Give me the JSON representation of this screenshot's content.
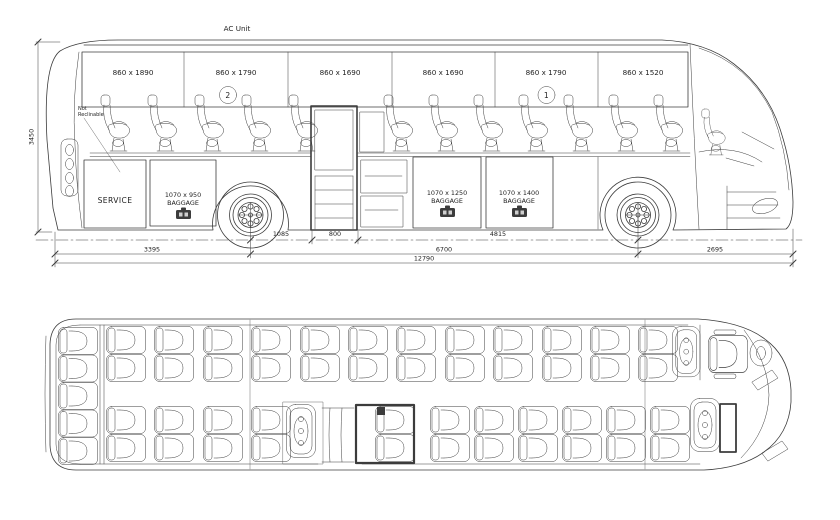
{
  "side_view": {
    "ac_unit_label": "AC Unit",
    "overall_height": "3450",
    "not_reclinable_1": "Not",
    "not_reclinable_2": "Reclinable",
    "service_label": "SERVICE",
    "windows": [
      {
        "label": "860 x 1890",
        "badge": ""
      },
      {
        "label": "860 x 1790",
        "badge": "2"
      },
      {
        "label": "860 x 1690",
        "badge": ""
      },
      {
        "label": "860 x 1690",
        "badge": ""
      },
      {
        "label": "860 x 1790",
        "badge": "1"
      },
      {
        "label": "860 x 1520",
        "badge": ""
      }
    ],
    "baggage_doors": [
      {
        "size": "1070 x 950",
        "label": "BAGGAGE"
      },
      {
        "size": "1070 x 1250",
        "label": "BAGGAGE"
      },
      {
        "size": "1070 x 1400",
        "label": "BAGGAGE"
      }
    ],
    "dimensions": {
      "rear_axle_to_mid_door": "1085",
      "mid_door_width": "800",
      "mid_door_to_front_axle": "4815",
      "rear_overhang": "3395",
      "wheelbase": "6700",
      "front_overhang": "2695",
      "overall_length": "12790"
    }
  },
  "floor_plan": {
    "rear_bench_seats": 5,
    "left_side_seat_pairs": 12,
    "door_side_seat_pairs": 11,
    "attendant_fold_seats": 3,
    "driver_seat": 1
  }
}
